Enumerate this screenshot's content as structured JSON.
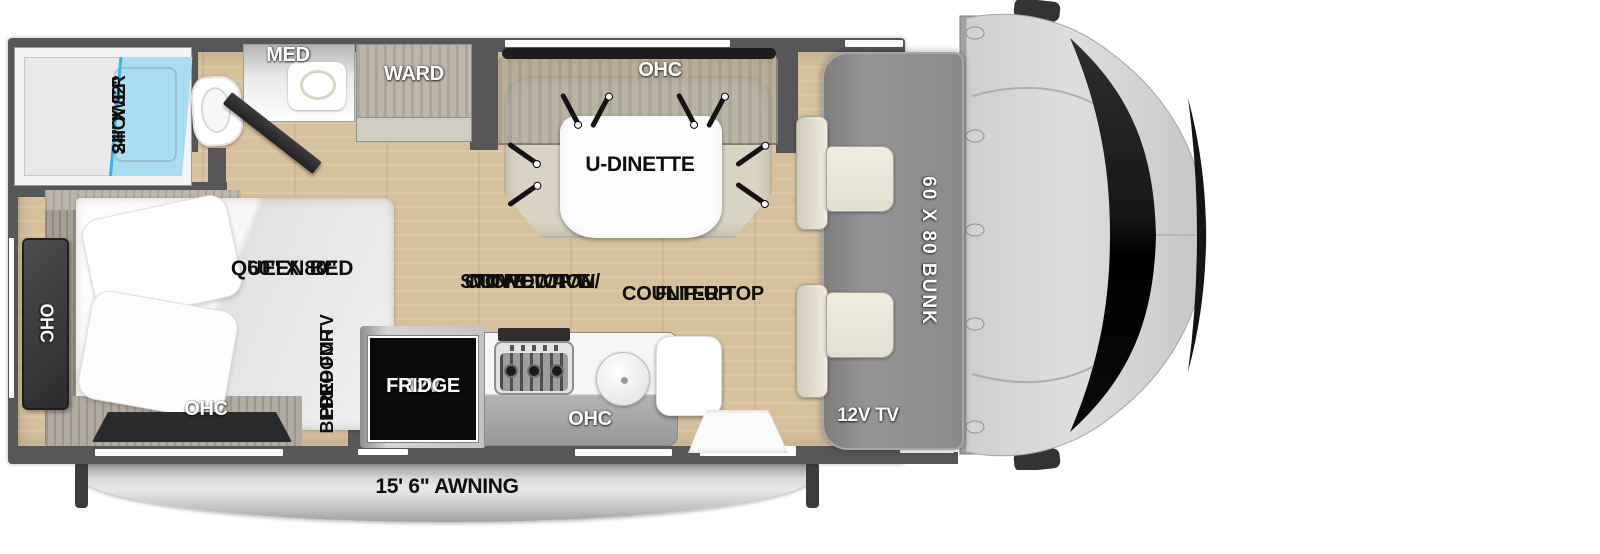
{
  "title": "RV Class C Motorhome Floorplan",
  "colors": {
    "wall": "#57575a",
    "floor_wood": "#d7c19c",
    "shower_glass": "#a9def2",
    "shower_divider": "#36b5e9",
    "bunk_gray": "#8e8e90",
    "bench_beige": "#d8d3c2",
    "seat_ivory": "#ece9dc",
    "dark_panel": "#2b2b2d",
    "fridge_black": "#0b0b0b",
    "awning_gray": "#c7c7c7",
    "cab_body": "#d8d8d8",
    "windshield_black": "#0d0d0d",
    "label_black": "#0e0e0e",
    "label_white": "#ffffff"
  },
  "labels": {
    "shower_line1": "24\" X 32\"",
    "shower_line2": "SHOWER",
    "med": "MED",
    "ward": "WARD",
    "dinette_ohc": "OHC",
    "dinette": "U-DINETTE",
    "bed_size": "60\" X 80\"",
    "bed_name": "QUEEN BED",
    "bed_ohc_side": "OHC",
    "bed_ohc_rear": "OHC",
    "tv_prep_line1": "PREP FOR",
    "tv_prep_line2": "BEDROOM TV",
    "stove_line1": "STOVE TOP W/",
    "stove_line2": "CONVECTION",
    "stove_line3": "MICROWAVE",
    "flip_line1": "FLIP-UP",
    "flip_line2": "COUNTER TOP",
    "fridge_line1": "12V",
    "fridge_line2": "FRIDGE",
    "kitchen_ohc": "OHC",
    "bunk": "60 X 80 BUNK",
    "cab_tv": "12V TV",
    "awning": "15' 6\" AWNING"
  }
}
